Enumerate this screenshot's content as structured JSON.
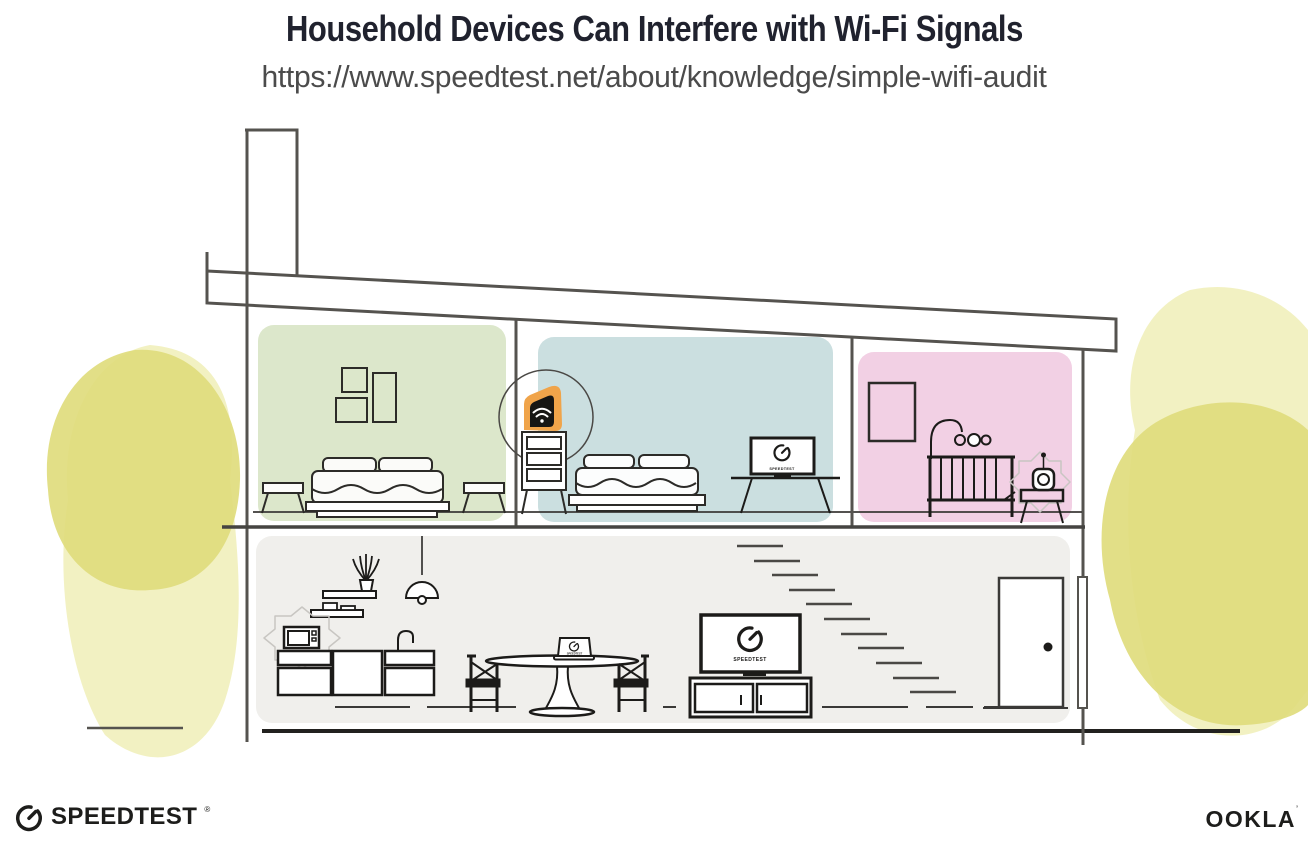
{
  "header": {
    "title": "Household Devices Can Interfere with Wi-Fi Signals",
    "url": "https://www.speedtest.net/about/knowledge/simple-wifi-audit"
  },
  "screens": {
    "bedroom_monitor": "SPEEDTEST",
    "living_room_tv": "SPEEDTEST",
    "dining_laptop": "SPEEDTEST"
  },
  "footer": {
    "speedtest_wordmark": "SPEEDTEST",
    "speedtest_mark": "®",
    "ookla_wordmark": "OOKLA",
    "ookla_mark": "’"
  },
  "colors": {
    "title_ink": "#20222e",
    "url_gray": "#4b4b4b",
    "outline": "#55534f",
    "ink": "#1c1b19",
    "router_highlight_orange": "#f0a44a",
    "bedroom_left_wall_green": "#dce7cb",
    "bedroom_middle_wall_blue": "#cbdfe0",
    "nursery_wall_pink": "#f2d0e4",
    "downstairs_wall_gray": "#f0efec",
    "foliage_yellow": "#dfdc7d",
    "foliage_yellow_light": "#edecae",
    "interference_burst_gray": "#c8c6c2"
  }
}
